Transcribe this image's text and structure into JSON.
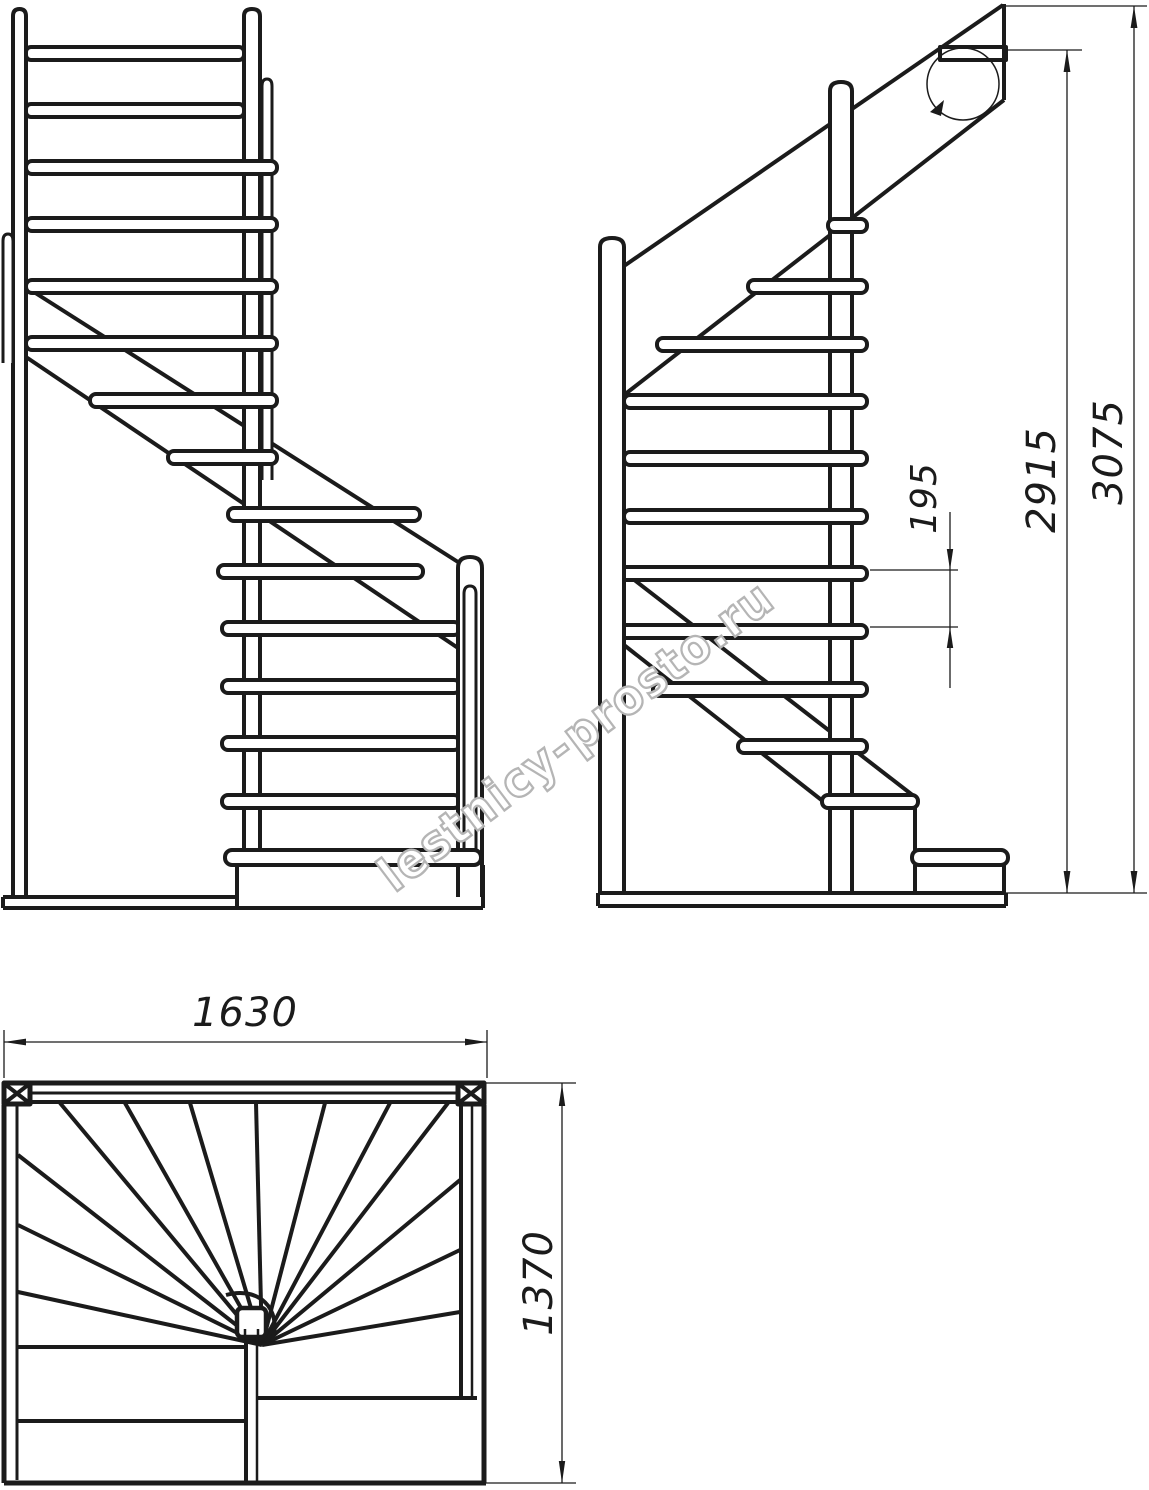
{
  "drawing": {
    "kind": "staircase-technical-drawing",
    "views": {
      "front_elevation": "front-elevation-view",
      "side_elevation": "side-elevation-view",
      "plan": "plan-view"
    }
  },
  "dimensions": {
    "riser_height": "195",
    "floor_to_floor": "2915",
    "total_height": "3075",
    "plan_width": "1630",
    "plan_depth": "1370"
  },
  "watermark": {
    "text": "lestnicy-prosto.ru"
  },
  "colors": {
    "line": "#1b1b1b",
    "background": "#ffffff",
    "watermark_stroke": "#b5b5b5",
    "watermark_fill": "#ffffff"
  }
}
